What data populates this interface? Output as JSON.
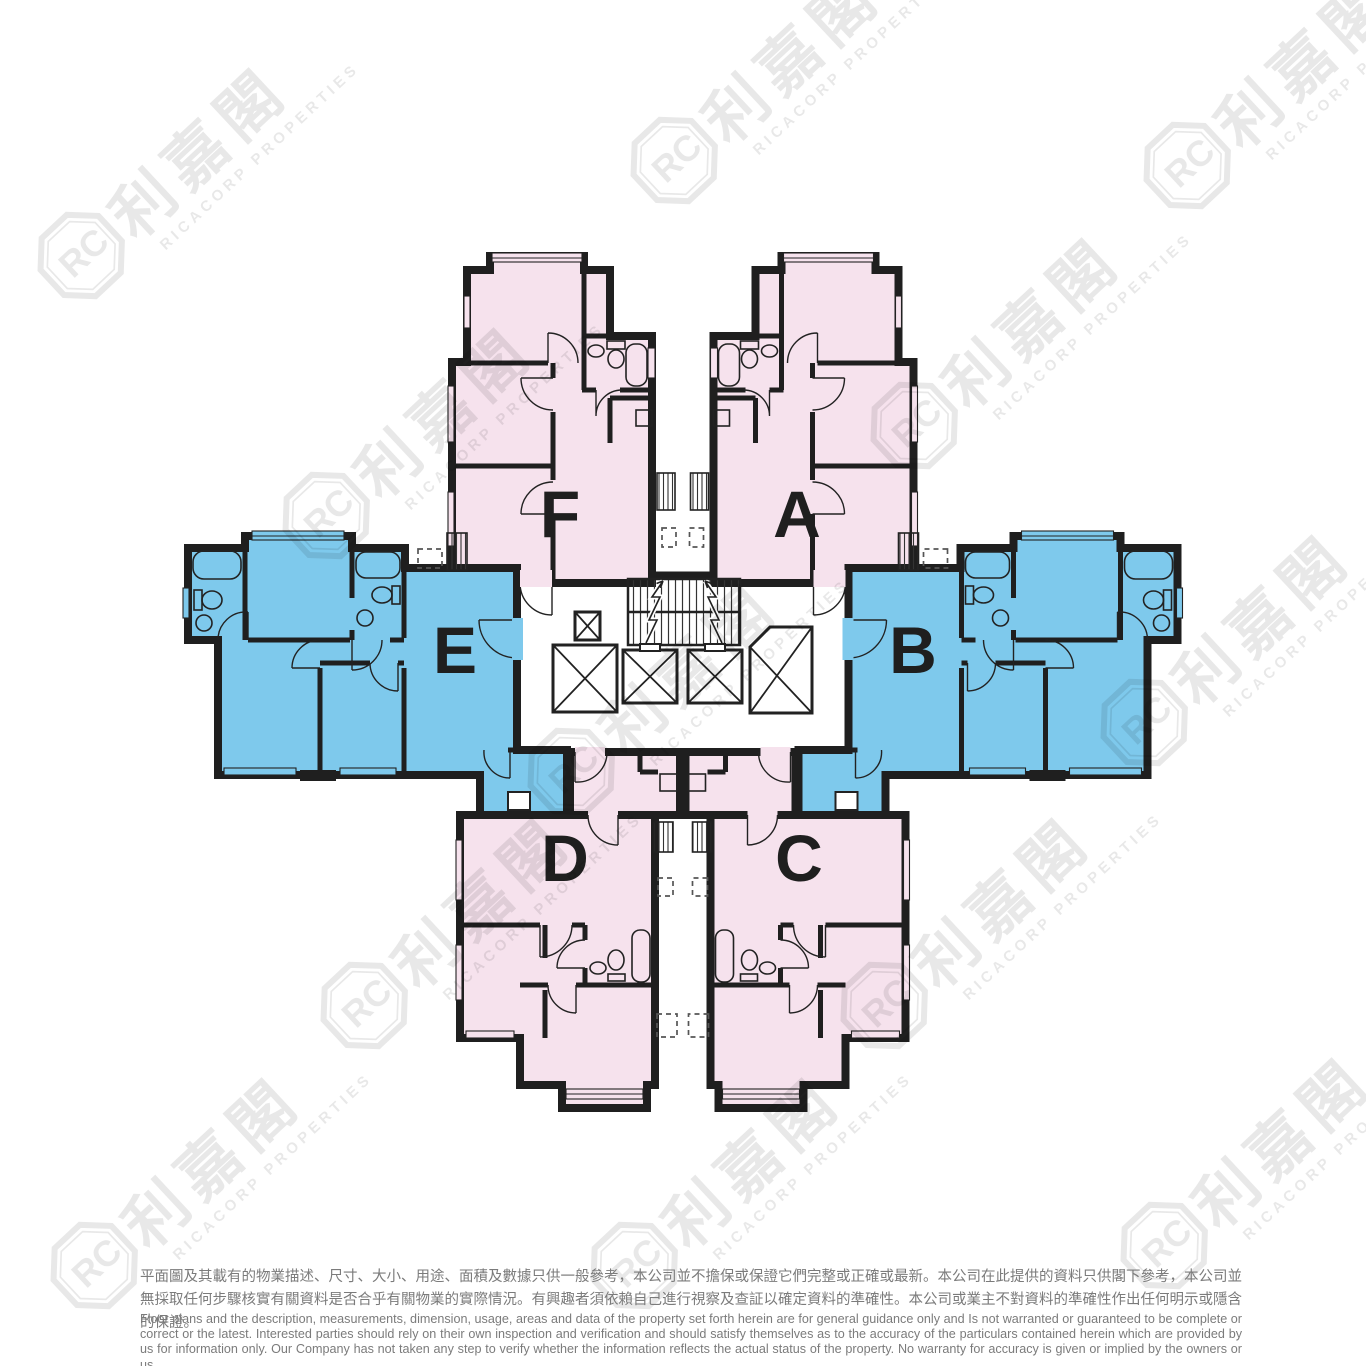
{
  "floor_plan": {
    "title": "residential-tower-typical-floor-plan",
    "units": [
      {
        "label": "A",
        "color_name": "pink"
      },
      {
        "label": "B",
        "color_name": "blue"
      },
      {
        "label": "C",
        "color_name": "pink"
      },
      {
        "label": "D",
        "color_name": "pink"
      },
      {
        "label": "E",
        "color_name": "blue"
      },
      {
        "label": "F",
        "color_name": "pink"
      }
    ],
    "colors": {
      "unit_pink": "#F6E2ED",
      "unit_blue": "#7EC9EC",
      "wall": "#1f1f1f",
      "background": "#ffffff",
      "disclaimer_text": "#7b7b7b"
    },
    "core_elements": [
      "staircase",
      "lift-shafts",
      "lobby",
      "light-wells"
    ]
  },
  "watermark": {
    "monogram": "RC",
    "chinese": "利嘉閣",
    "english": "RICACORP PROPERTIES"
  },
  "disclaimer": {
    "chinese": "平面圖及其載有的物業描述、尺寸、大小、用途、面積及數據只供一般參考，本公司並不擔保或保證它們完整或正確或最新。本公司在此提供的資料只供閣下參考，本公司並無採取任何步驟核實有關資料是否合乎有關物業的實際情況。有興趣者須依賴自己進行視察及查証以確定資料的準確性。本公司或業主不對資料的準確性作出任何明示或隱含的保證。",
    "english": "Floor plans and the description, measurements, dimension, usage, areas and data of the property set forth herein are for general guidance only and Is not warranted or guaranteed to be complete or correct or the latest. Interested parties should rely on their own inspection and verification and should satisfy themselves as to the accuracy of the particulars contained herein which are provided by us for information only.  Our Company has not taken any step to verify whether the information reflects the actual status of the property.  No warranty for accuracy is given or implied by the owners or us."
  }
}
